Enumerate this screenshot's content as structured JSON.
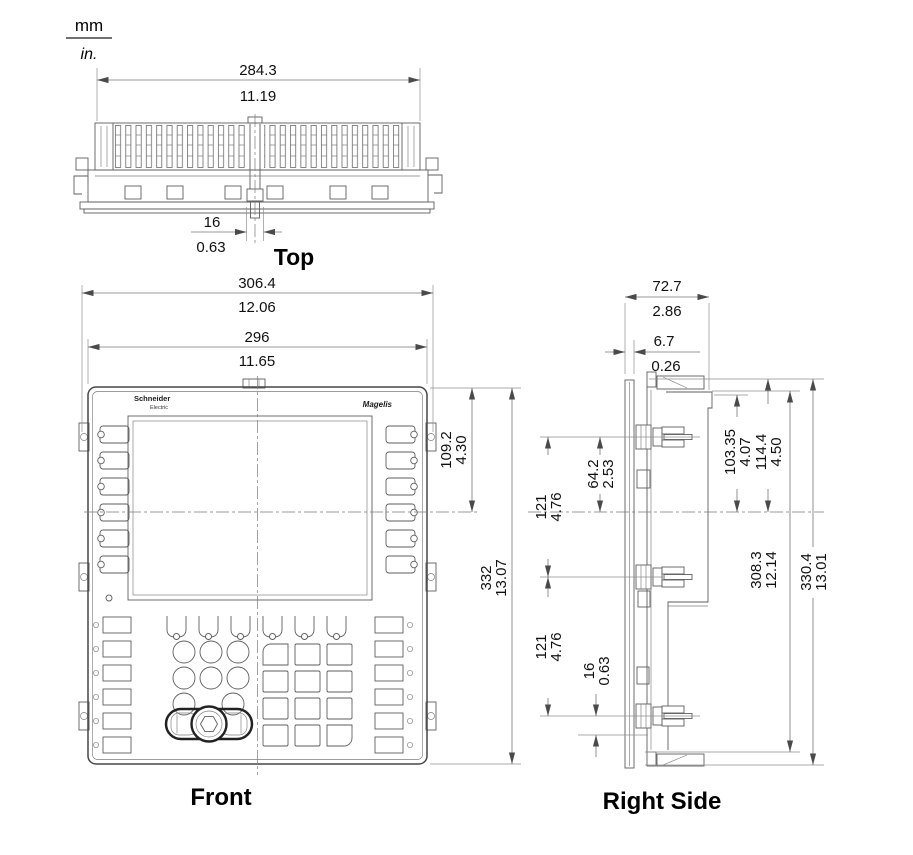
{
  "units_legend": {
    "primary": "mm",
    "secondary": "in."
  },
  "views": {
    "top": {
      "label": "Top",
      "dims": {
        "body_width": {
          "mm": "284.3",
          "in": "11.19"
        },
        "clip_width": {
          "mm": "16",
          "in": "0.63"
        }
      }
    },
    "front": {
      "label": "Front",
      "logo": {
        "brand": "Schneider",
        "brand_sub": "Electric",
        "product": "Magelis"
      },
      "dims": {
        "overall_width": {
          "mm": "306.4",
          "in": "12.06"
        },
        "bezel_width": {
          "mm": "296",
          "in": "11.65"
        },
        "top_to_centerline": {
          "mm": "109.2",
          "in": "4.30"
        },
        "overall_height": {
          "mm": "332",
          "in": "13.07"
        }
      }
    },
    "right_side": {
      "label": "Right Side",
      "dims": {
        "overall_depth": {
          "mm": "72.7",
          "in": "2.86"
        },
        "bezel_depth": {
          "mm": "6.7",
          "in": "0.26"
        },
        "clamp_to_centerline": {
          "mm": "64.2",
          "in": "2.53"
        },
        "clamp_pitch_upper": {
          "mm": "121",
          "in": "4.76"
        },
        "clamp_pitch_lower": {
          "mm": "121",
          "in": "4.76"
        },
        "clamp_offset_bottom": {
          "mm": "16",
          "in": "0.63"
        },
        "body_top_to_centerline": {
          "mm": "103.35",
          "in": "4.07"
        },
        "top_to_centerline": {
          "mm": "114.4",
          "in": "4.50"
        },
        "body_height": {
          "mm": "308.3",
          "in": "12.14"
        },
        "overall_height": {
          "mm": "330.4",
          "in": "13.01"
        }
      }
    }
  }
}
